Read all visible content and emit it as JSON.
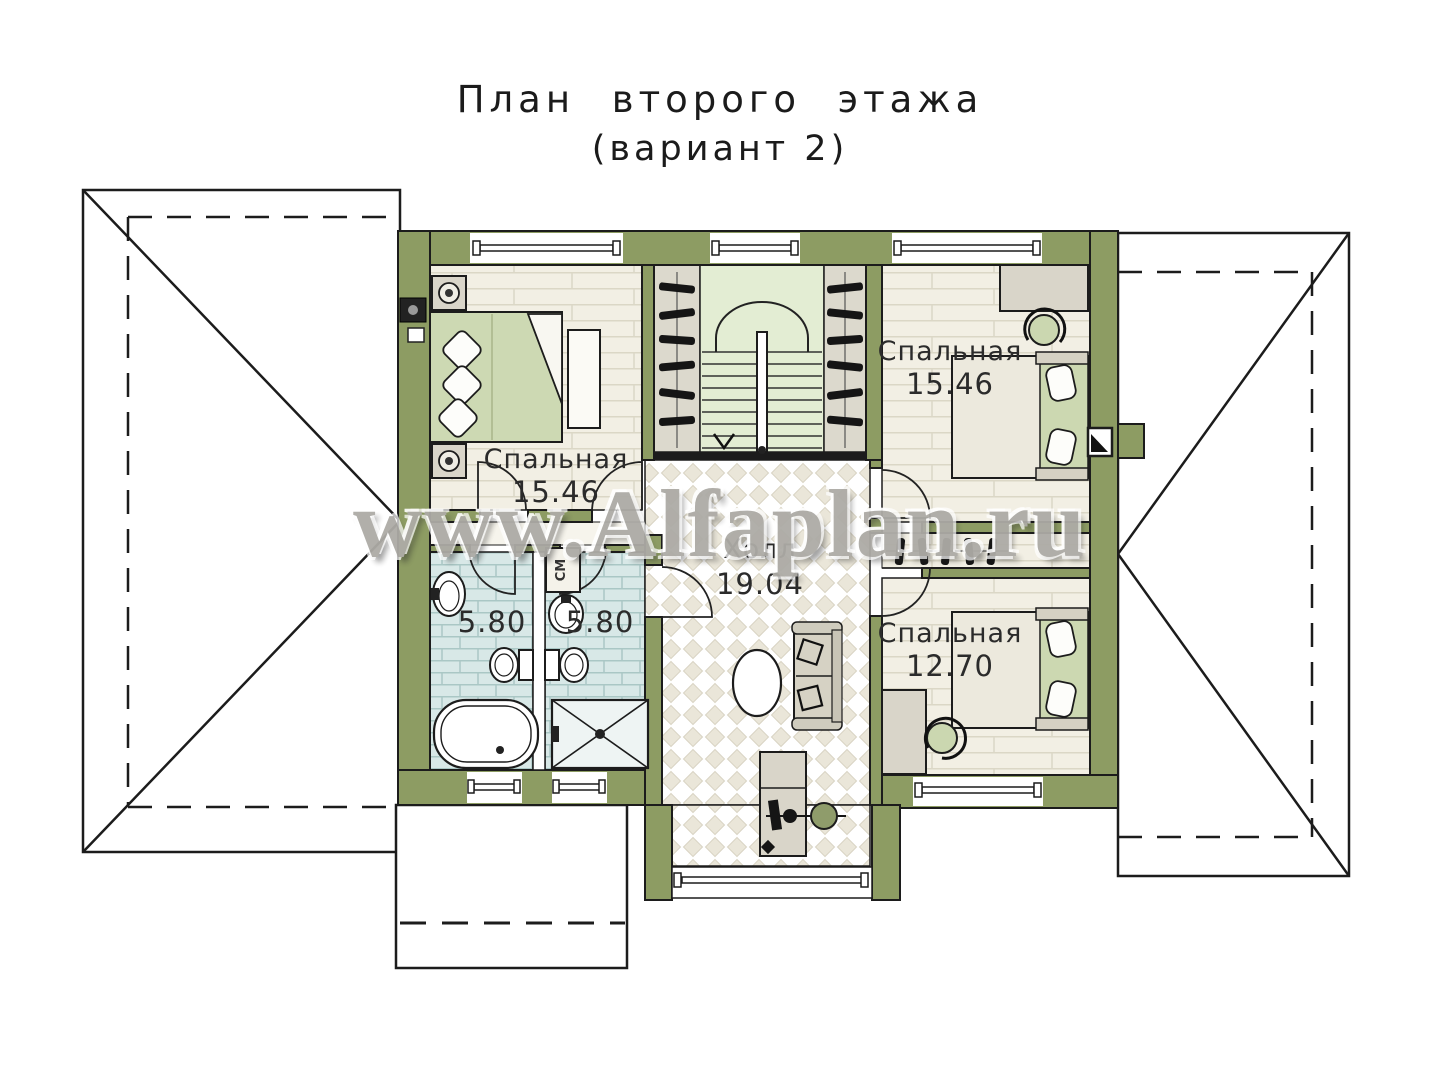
{
  "title": {
    "line1": "План второго этажа",
    "line2": "(вариант 2)"
  },
  "watermark": "www.Alfaplan.ru",
  "rooms": [
    {
      "id": "bedroom-left",
      "name": "Спальная",
      "area": "15.46"
    },
    {
      "id": "bedroom-top-right",
      "name": "Спальная",
      "area": "15.46"
    },
    {
      "id": "bedroom-bottom-right",
      "name": "Спальная",
      "area": "12.70"
    },
    {
      "id": "bathroom-left",
      "area": "5.80"
    },
    {
      "id": "bathroom-right",
      "area": "5.80"
    },
    {
      "id": "hall",
      "name": "Холл",
      "area": "19.04"
    }
  ],
  "labels": {
    "washing_machine": "СМ"
  },
  "colors": {
    "wall_olive": "#8d9c63",
    "stair_green": "#e3edd3",
    "bath_tile": "#d8e8e7",
    "floor_plank": "#f2efe4",
    "hall_tile": "#eae6d9",
    "bed_blanket": "#cdd9b3",
    "watermark_gray": "#adaba6",
    "outline_black": "#1c1c1c"
  }
}
